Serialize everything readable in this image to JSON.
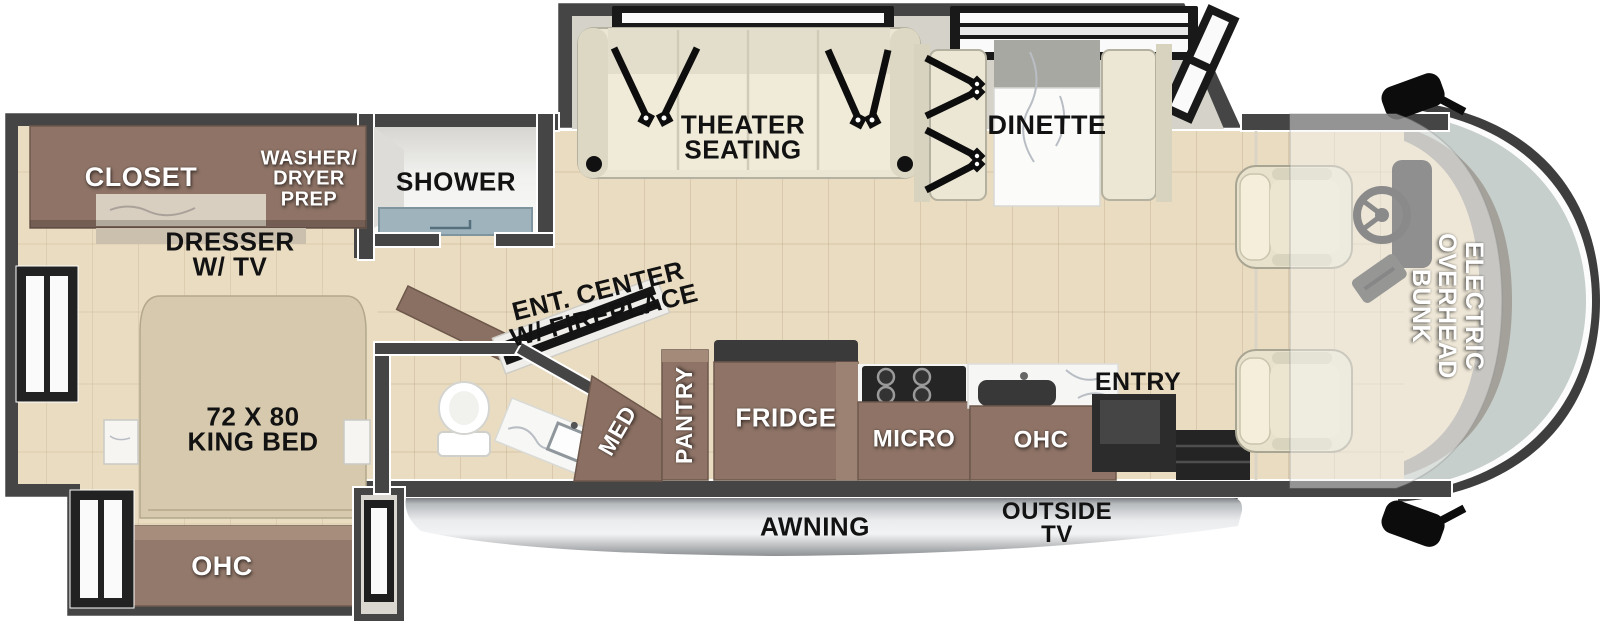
{
  "colors": {
    "wall": "#454545",
    "floor": "#eadcc0",
    "cabinet_brown": "#8e7366",
    "bed_beige": "#d7c9ad",
    "seating_cream": "#ece7d4",
    "windshield_glass": "#c6cfcb",
    "shower_pan": "#9fb3bd",
    "awning_gray": "#c9ccd0",
    "label_dark": "#121212",
    "label_light": "#ffffff"
  },
  "bedroom": {
    "closet_label": "CLOSET",
    "washer_dryer_label": "WASHER/\nDRYER\nPREP",
    "dresser_label": "DRESSER\nW/ TV",
    "bed_label": "72 X 80\nKING BED",
    "ohc_label": "OHC"
  },
  "bath": {
    "shower_label": "SHOWER",
    "med_label": "MED",
    "ent_center_label": "ENT. CENTER\nW/ FIREPLACE"
  },
  "kitchen": {
    "pantry_label": "PANTRY",
    "fridge_label": "FRIDGE",
    "micro_label": "MICRO",
    "ohc_label": "OHC",
    "entry_label": "ENTRY"
  },
  "living": {
    "theater_label": "THEATER\nSEATING",
    "dinette_label": "DINETTE"
  },
  "cab": {
    "bunk_label": "ELECTRIC\nOVERHEAD\nBUNK"
  },
  "exterior": {
    "awning_label": "AWNING",
    "outside_tv_label": "OUTSIDE\nTV"
  }
}
